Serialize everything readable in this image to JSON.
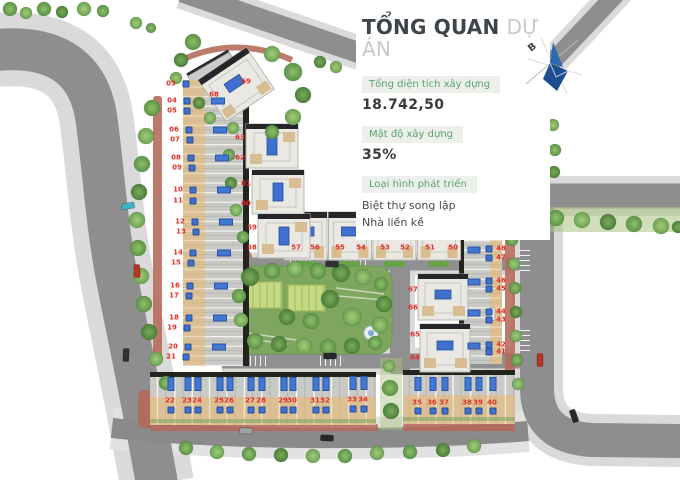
{
  "panel": {
    "title": {
      "main": "TỔNG QUAN",
      "sub": "DỰ ÁN"
    },
    "stats": [
      {
        "label": "Tổng diện tích xây dựng",
        "value": "18.742,50"
      },
      {
        "label": "Mật độ xây dựng",
        "value": "35%"
      },
      {
        "label": "Loại hình phát triển",
        "lines": [
          "Biệt thự song lập",
          "Nhà liền kề"
        ]
      }
    ],
    "compass": {
      "label": "B"
    }
  },
  "colors": {
    "accent_green": "#57a46c",
    "lot_number_red": "#e02f28",
    "pool_blue": "#3f6fd0",
    "compass_blue": "#1d4e90",
    "road_gray": "#8e8e8e",
    "sidewalk_gray": "#dadada",
    "park_green": "#7ea65e",
    "roof_tan": "#dcc094"
  },
  "map": {
    "lot_groups": {
      "left_column": [
        "03",
        "04",
        "05",
        "06",
        "07",
        "08",
        "09",
        "10",
        "11",
        "12",
        "13",
        "14",
        "15",
        "16",
        "17",
        "18",
        "19",
        "20",
        "21"
      ],
      "bottom_row": [
        "22",
        "23",
        "24",
        "25",
        "26",
        "27",
        "28",
        "29",
        "30",
        "31",
        "32",
        "33",
        "34"
      ],
      "bottom_right_row": [
        "35",
        "36",
        "37",
        "38",
        "39",
        "40"
      ],
      "right_column": [
        "49",
        "48",
        "47",
        "46",
        "45",
        "44",
        "43",
        "42",
        "41"
      ],
      "villa_row": [
        "57",
        "56",
        "55",
        "54",
        "53",
        "52",
        "51",
        "50"
      ],
      "villa_left_column": [
        "63",
        "62",
        "61",
        "60",
        "59",
        "58"
      ],
      "villa_right_column": [
        "67",
        "66",
        "65",
        "64"
      ],
      "entrance_villa": [
        "68",
        "69"
      ]
    }
  }
}
